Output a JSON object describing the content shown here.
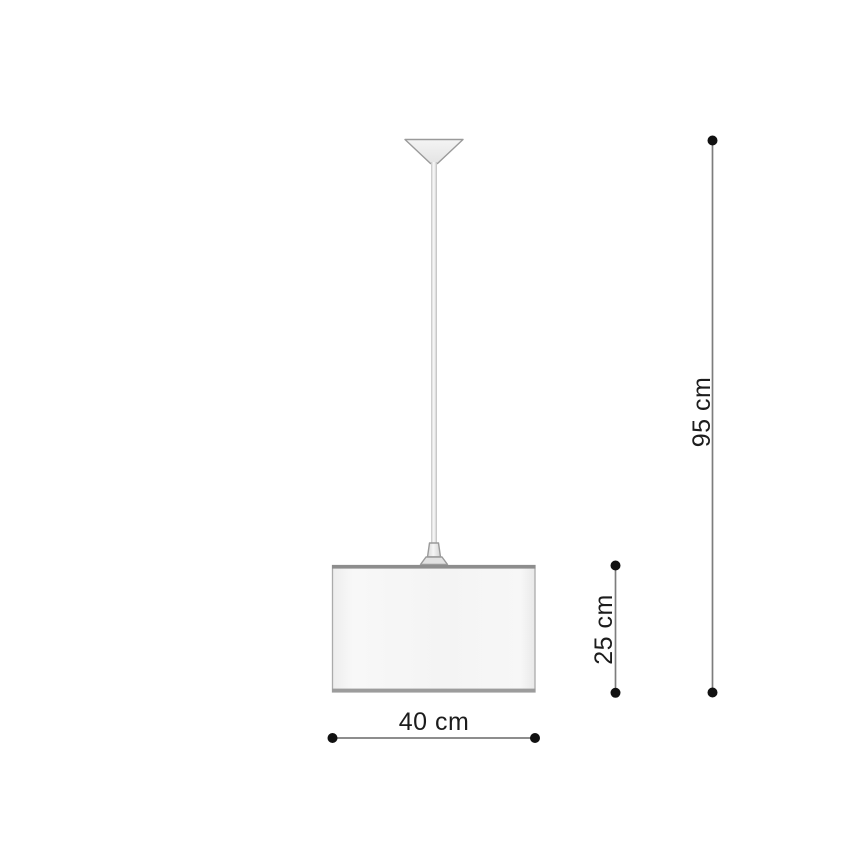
{
  "diagram": {
    "labels": {
      "total_height": "95 cm",
      "shade_height": "25 cm",
      "shade_width": "40 cm"
    },
    "values_cm": {
      "total_height": 95,
      "shade_height": 25,
      "shade_width": 40
    },
    "colors": {
      "background": "#ffffff",
      "dimension_line": "#7d7d7d",
      "dimension_dot": "#111111",
      "label_text": "#1c1c1c",
      "lamp_outline": "#9a9a9a",
      "shade_border": "#ababab",
      "shade_top_edge": "#8d8d8d",
      "shade_bottom_edge": "#9c9c9c"
    }
  }
}
